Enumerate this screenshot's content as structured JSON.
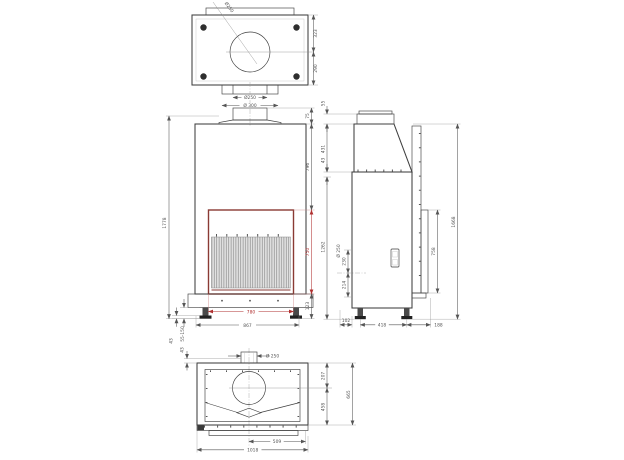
{
  "colors": {
    "outline": "#3f3f3f",
    "dim_line": "#555555",
    "dim_red": "#b03030",
    "frame_red": "#8a3a34"
  },
  "top_view": {
    "flue": "Ø250",
    "rear_to_flue": "323",
    "flue_to_front": "290",
    "collar_inner": "Ø250",
    "collar_outer": "Ø 300"
  },
  "front_view": {
    "total_height": "1778",
    "collar_height": "75",
    "top_to_opening": "796",
    "opening_height": "750",
    "opening_width": "780",
    "feet_span": "867",
    "base_height": "123",
    "feet_adjust": "55-150",
    "foot_pad": "43"
  },
  "between_views": {
    "hood_cap": "55",
    "hood_height": "431",
    "hood_step": "43",
    "body_height": "1262"
  },
  "side_view": {
    "total_height": "1668",
    "rear_duct_height": "758",
    "rear_outlet": "Ø 250",
    "outlet_above": "230",
    "outlet_below": "214",
    "front_foot_offset": "102",
    "feet_spacing": "418",
    "rear_overhang": "188"
  },
  "bottom_view": {
    "collar": "Ø 250",
    "collar_offset": "43",
    "rear_to_center": "207",
    "center_to_front": "458",
    "depth": "665",
    "center_to_edge": "509",
    "total_width": "1018"
  }
}
